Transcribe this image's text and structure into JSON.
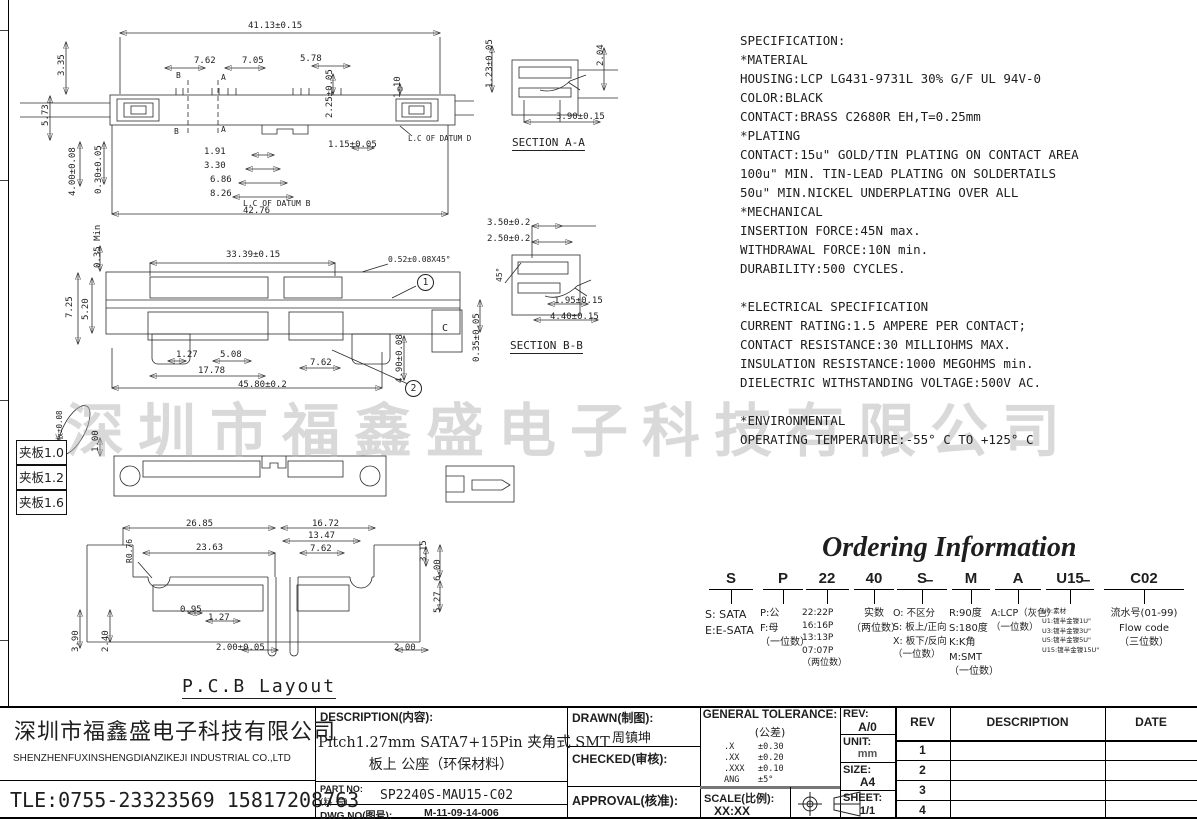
{
  "watermark": {
    "text": "深圳市福鑫盛电子科技有限公司"
  },
  "specification": {
    "lines": [
      "SPECIFICATION:",
      "*MATERIAL",
      "HOUSING:LCP LG431-9731L 30% G/F UL 94V-0",
      "COLOR:BLACK",
      "CONTACT:BRASS C2680R EH,T=0.25mm",
      "*PLATING",
      "CONTACT:15u\" GOLD/TIN PLATING ON CONTACT AREA",
      "100u\" MIN. TIN-LEAD PLATING ON SOLDERTAILS",
      "50u\" MIN.NICKEL UNDERPLATING OVER ALL",
      "*MECHANICAL",
      "INSERTION FORCE:45N max.",
      "WITHDRAWAL FORCE:10N min.",
      "DURABILITY:500 CYCLES.",
      "",
      "*ELECTRICAL SPECIFICATION",
      "CURRENT RATING:1.5 AMPERE PER CONTACT;",
      "CONTACT RESISTANCE:30 MILLIOHMS MAX.",
      "INSULATION RESISTANCE:1000 MEGOHMS min.",
      "DIELECTRIC WITHSTANDING VOLTAGE:500V AC.",
      "",
      "*ENVIRONMENTAL",
      "OPERATING TEMPERATURE:-55° C TO +125° C"
    ]
  },
  "captions": {
    "section_aa": "SECTION A-A",
    "section_bb": "SECTION B-B",
    "pcb_layout": "P.C.B  Layout"
  },
  "clamp_labels": [
    "夹板1.0",
    "夹板1.2",
    "夹板1.6"
  ],
  "callouts": {
    "circle_1": "1",
    "circle_2": "2"
  },
  "dims": {
    "view_top": [
      {
        "t": "41.13±0.15",
        "x": 248,
        "y": 22
      },
      {
        "t": "7.62",
        "x": 194,
        "y": 57
      },
      {
        "t": "7.05",
        "x": 242,
        "y": 57
      },
      {
        "t": "5.78",
        "x": 300,
        "y": 55
      },
      {
        "t": "2.25±0.05",
        "x": 326,
        "y": 118,
        "r": 1
      },
      {
        "t": "1.10",
        "x": 394,
        "y": 98,
        "r": 1
      },
      {
        "t": "B",
        "x": 176,
        "y": 72,
        "fs": 8
      },
      {
        "t": "A",
        "x": 221,
        "y": 74,
        "fs": 8
      },
      {
        "t": "B",
        "x": 174,
        "y": 128,
        "fs": 8
      },
      {
        "t": "A",
        "x": 221,
        "y": 126,
        "fs": 8
      },
      {
        "t": "1.15±0.05",
        "x": 328,
        "y": 141
      },
      {
        "t": "L.C OF DATUM D",
        "x": 408,
        "y": 135,
        "fs": 7.5
      },
      {
        "t": "1.91",
        "x": 204,
        "y": 148
      },
      {
        "t": "3.30",
        "x": 204,
        "y": 162
      },
      {
        "t": "6.86",
        "x": 210,
        "y": 176
      },
      {
        "t": "8.26",
        "x": 210,
        "y": 190
      },
      {
        "t": "L.C OF DATUM B",
        "x": 243,
        "y": 200,
        "fs": 8
      },
      {
        "t": "42.76",
        "x": 243,
        "y": 207
      },
      {
        "t": "3.35",
        "x": 58,
        "y": 76,
        "r": 1
      },
      {
        "t": "5.73",
        "x": 42,
        "y": 126,
        "r": 1
      },
      {
        "t": "4.00±0.08",
        "x": 69,
        "y": 196,
        "r": 1
      },
      {
        "t": "0.30±0.05",
        "x": 95,
        "y": 194,
        "r": 1
      }
    ],
    "section_aa": [
      {
        "t": "1.23±0.05",
        "x": 486,
        "y": 88,
        "r": 1
      },
      {
        "t": "2.04",
        "x": 597,
        "y": 66,
        "r": 1
      },
      {
        "t": "3.90±0.15",
        "x": 556,
        "y": 113
      }
    ],
    "section_bb": [
      {
        "t": "3.50±0.2",
        "x": 487,
        "y": 219
      },
      {
        "t": "2.50±0.2",
        "x": 487,
        "y": 235
      },
      {
        "t": "45°",
        "x": 496,
        "y": 282,
        "r": 1,
        "fs": 8
      },
      {
        "t": "1.95±0.15",
        "x": 554,
        "y": 297
      },
      {
        "t": "4.40±0.15",
        "x": 550,
        "y": 313
      },
      {
        "t": "0.35±0.05",
        "x": 473,
        "y": 362,
        "r": 1
      }
    ],
    "view_front": [
      {
        "t": "0.35 Min",
        "x": 94,
        "y": 268,
        "r": 1
      },
      {
        "t": "33.39±0.15",
        "x": 226,
        "y": 251
      },
      {
        "t": "0.52±0.08X45°",
        "x": 388,
        "y": 256,
        "fs": 8
      },
      {
        "t": "7.25",
        "x": 66,
        "y": 318,
        "r": 1
      },
      {
        "t": "5.20",
        "x": 82,
        "y": 320,
        "r": 1
      },
      {
        "t": "C",
        "x": 442,
        "y": 324,
        "fs": 10
      },
      {
        "t": "4.90±0.08",
        "x": 396,
        "y": 383,
        "r": 1
      },
      {
        "t": "1.27",
        "x": 176,
        "y": 351
      },
      {
        "t": "5.08",
        "x": 220,
        "y": 351
      },
      {
        "t": "17.78",
        "x": 198,
        "y": 367
      },
      {
        "t": "7.62",
        "x": 310,
        "y": 359
      },
      {
        "t": "45.80±0.2",
        "x": 238,
        "y": 381
      }
    ],
    "view_bottom": [
      {
        "t": "夹板±0.08",
        "x": 56,
        "y": 448,
        "r": 1,
        "fs": 7.5
      },
      {
        "t": "1.00",
        "x": 92,
        "y": 452,
        "r": 1
      }
    ],
    "pcb": [
      {
        "t": "26.85",
        "x": 186,
        "y": 520
      },
      {
        "t": "16.72",
        "x": 312,
        "y": 520
      },
      {
        "t": "13.47",
        "x": 308,
        "y": 532
      },
      {
        "t": "23.63",
        "x": 196,
        "y": 544
      },
      {
        "t": "7.62",
        "x": 310,
        "y": 545
      },
      {
        "t": "R0.76",
        "x": 126,
        "y": 563,
        "r": 1,
        "fs": 8
      },
      {
        "t": "3.15",
        "x": 420,
        "y": 562,
        "r": 1
      },
      {
        "t": "6.00",
        "x": 434,
        "y": 581,
        "r": 1
      },
      {
        "t": "5.27",
        "x": 434,
        "y": 613,
        "r": 1
      },
      {
        "t": "0.95",
        "x": 180,
        "y": 606
      },
      {
        "t": "1.27",
        "x": 208,
        "y": 614
      },
      {
        "t": "3.90",
        "x": 72,
        "y": 652,
        "r": 1
      },
      {
        "t": "2.40",
        "x": 102,
        "y": 652,
        "r": 1
      },
      {
        "t": "2.00±0.05",
        "x": 216,
        "y": 644
      },
      {
        "t": "2.00",
        "x": 394,
        "y": 644
      }
    ]
  },
  "ordering": {
    "title": "Ordering Information",
    "dash": "–",
    "columns": [
      {
        "code": "S",
        "lines": [
          "S: SATA",
          "E:E-SATA"
        ]
      },
      {
        "code": "P",
        "lines": [
          "P:公",
          "F:母",
          "（一位数）"
        ]
      },
      {
        "code": "22",
        "lines": [
          "22:22P",
          "16:16P",
          "13:13P",
          "07:07P",
          "（两位数）"
        ]
      },
      {
        "code": "40",
        "lines": [
          "实数",
          "（两位数）"
        ]
      },
      {
        "code": "S",
        "lines": [
          "O: 不区分",
          "S: 板上/正向",
          "X: 板下/反向",
          "（一位数）"
        ]
      },
      {
        "code": "M",
        "lines": [
          "R:90度",
          "S:180度",
          "K:K角",
          "M:SMT",
          "（一位数）"
        ]
      },
      {
        "code": "A",
        "lines": [
          "A:LCP（灰色）",
          "（一位数）"
        ]
      },
      {
        "code": "U15",
        "lines": [
          "U0:素材",
          "U1:镀半金镍1U\"",
          "U3:镀半金镍3U\"",
          "U5:镀半金镍5U\"",
          "U15:镀半金镍15U\""
        ]
      },
      {
        "code": "C02",
        "lines": [
          "流水号(01-99)",
          "Flow code",
          "（三位数）"
        ]
      }
    ]
  },
  "titleblock": {
    "company_cn": "深圳市福鑫盛电子科技有限公司",
    "company_en": "SHENZHENFUXINSHENGDIANZIKEJI INDUSTRIAL CO.,LTD",
    "tel": "TLE:0755-23323569 15817208763",
    "description_label": "DESCRIPTION(内容):",
    "description_line1": "Pitch1.27mm SATA7+15Pin 夹角式 SMT",
    "description_line2": "板上 公座（环保材料）",
    "part_no_label1": "PART NO:",
    "part_no_label2": "(料  号)",
    "part_no": "SP2240S-MAU15-C02",
    "dwg_no_label": "DWG NO(图号):",
    "dwg_no": "M-11-09-14-006",
    "drawn_label": "DRAWN(制图):",
    "drawn_value": "周镇坤",
    "checked_label": "CHECKED(审核):",
    "approval_label": "APPROVAL(核准):",
    "tolerance_title": "GENERAL TOLERANCE:",
    "tolerance_sub": "(公差)",
    "tolerances": [
      {
        "k": ".X",
        "v": "±0.30"
      },
      {
        "k": ".XX",
        "v": "±0.20"
      },
      {
        "k": ".XXX",
        "v": "±0.10"
      },
      {
        "k": "ANG",
        "v": "±5°"
      }
    ],
    "scale_label": "SCALE(比例):",
    "scale_value": "XX:XX",
    "rev_label": "REV:",
    "rev_value": "A/0",
    "unit_label": "UNIT:",
    "unit_value": "mm",
    "size_label": "SIZE:",
    "size_value": "A4",
    "sheet_label": "SHEET:",
    "sheet_value": "1/1",
    "rev_table": {
      "headers": {
        "rev": "REV",
        "description": "DESCRIPTION",
        "date": "DATE"
      },
      "rows": [
        "1",
        "2",
        "3",
        "4"
      ]
    }
  }
}
